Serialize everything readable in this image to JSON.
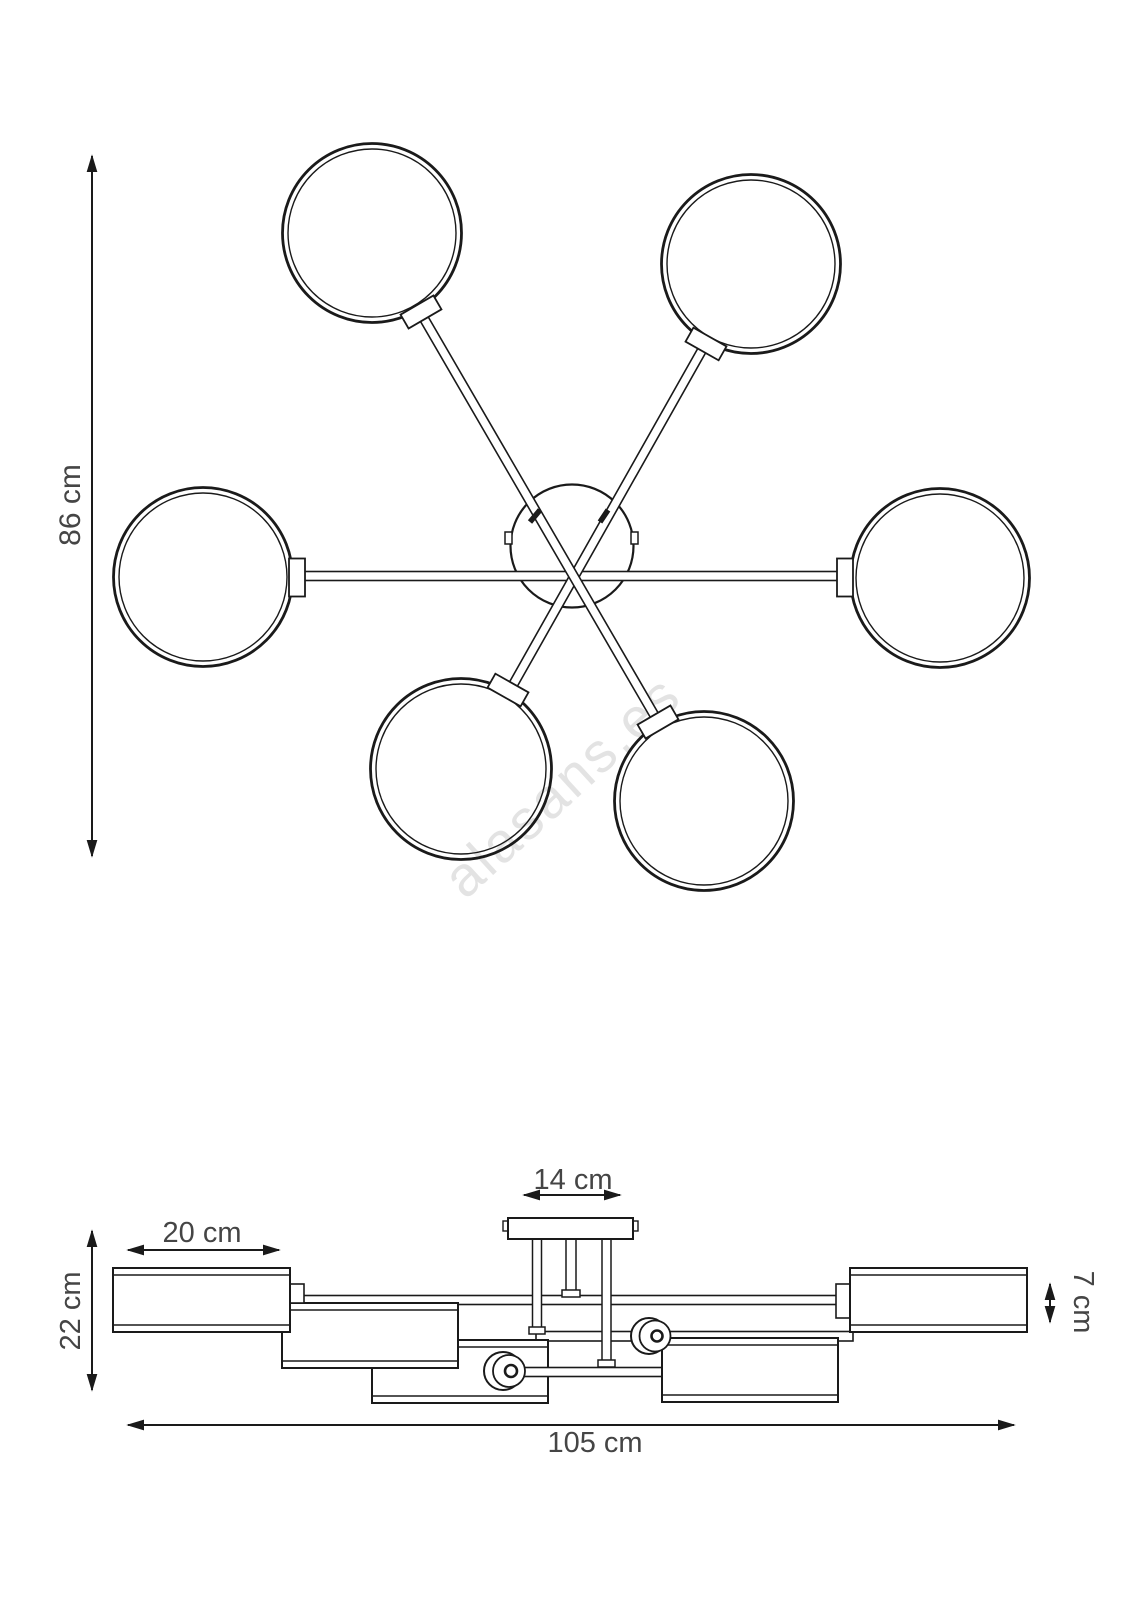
{
  "diagram": {
    "watermark": "alasans.es",
    "colors": {
      "line": "#1a1a1a",
      "dimension_text": "#454545",
      "watermark": "#e3e3e3",
      "background": "#ffffff"
    },
    "top_view": {
      "shade_count": 6,
      "dimension_height": "86 cm"
    },
    "side_view": {
      "dimension_shade_width": "20 cm",
      "dimension_canopy_width": "14 cm",
      "dimension_fixture_height": "22 cm",
      "dimension_shade_height": "7 cm",
      "dimension_total_width": "105 cm"
    }
  }
}
